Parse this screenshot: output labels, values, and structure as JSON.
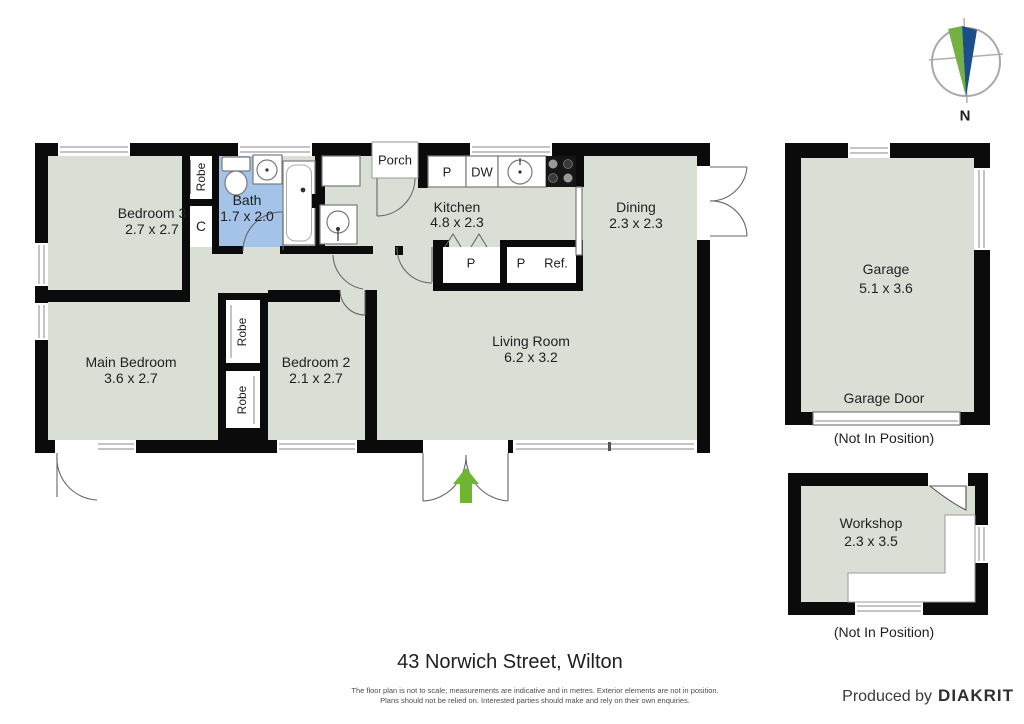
{
  "rooms": {
    "bedroom3": {
      "name": "Bedroom 3",
      "dims": "2.7 x 2.7"
    },
    "bath": {
      "name": "Bath",
      "dims": "1.7 x 2.0"
    },
    "kitchen": {
      "name": "Kitchen",
      "dims": "4.8 x 2.3"
    },
    "dining": {
      "name": "Dining",
      "dims": "2.3 x 2.3"
    },
    "main_bedroom": {
      "name": "Main Bedroom",
      "dims": "3.6 x 2.7"
    },
    "bedroom2": {
      "name": "Bedroom 2",
      "dims": "2.1 x 2.7"
    },
    "living": {
      "name": "Living Room",
      "dims": "6.2 x 3.2"
    },
    "garage": {
      "name": "Garage",
      "dims": "5.1 x 3.6"
    },
    "workshop": {
      "name": "Workshop",
      "dims": "2.3 x 3.5"
    }
  },
  "labels": {
    "porch": "Porch",
    "robe": "Robe",
    "closet": "C",
    "pantry": "P",
    "dishwasher": "DW",
    "fridge": "Ref.",
    "garage_door": "Garage Door",
    "not_in_position": "(Not In Position)"
  },
  "compass": {
    "north_label": "N"
  },
  "footer": {
    "address": "43 Norwich Street, Wilton",
    "disclaimer_line1": "The floor plan is not to scale; measurements are indicative and in metres. Exterior elements are not in position.",
    "disclaimer_line2": "Plans should not be relied on. Interested parties should make and rely on their own enquiries.",
    "produced_by": "Produced by",
    "brand": "DIAKRIT"
  },
  "colors": {
    "floor": "#d9dfd5",
    "bath_floor": "#a3c4e8",
    "wall": "#0b0b0b",
    "arrow": "#6fb62f",
    "compass_green": "#76b043",
    "compass_blue": "#1c4e8c",
    "north_text": "#2d5f9c",
    "address_text": "#3f5d70"
  }
}
